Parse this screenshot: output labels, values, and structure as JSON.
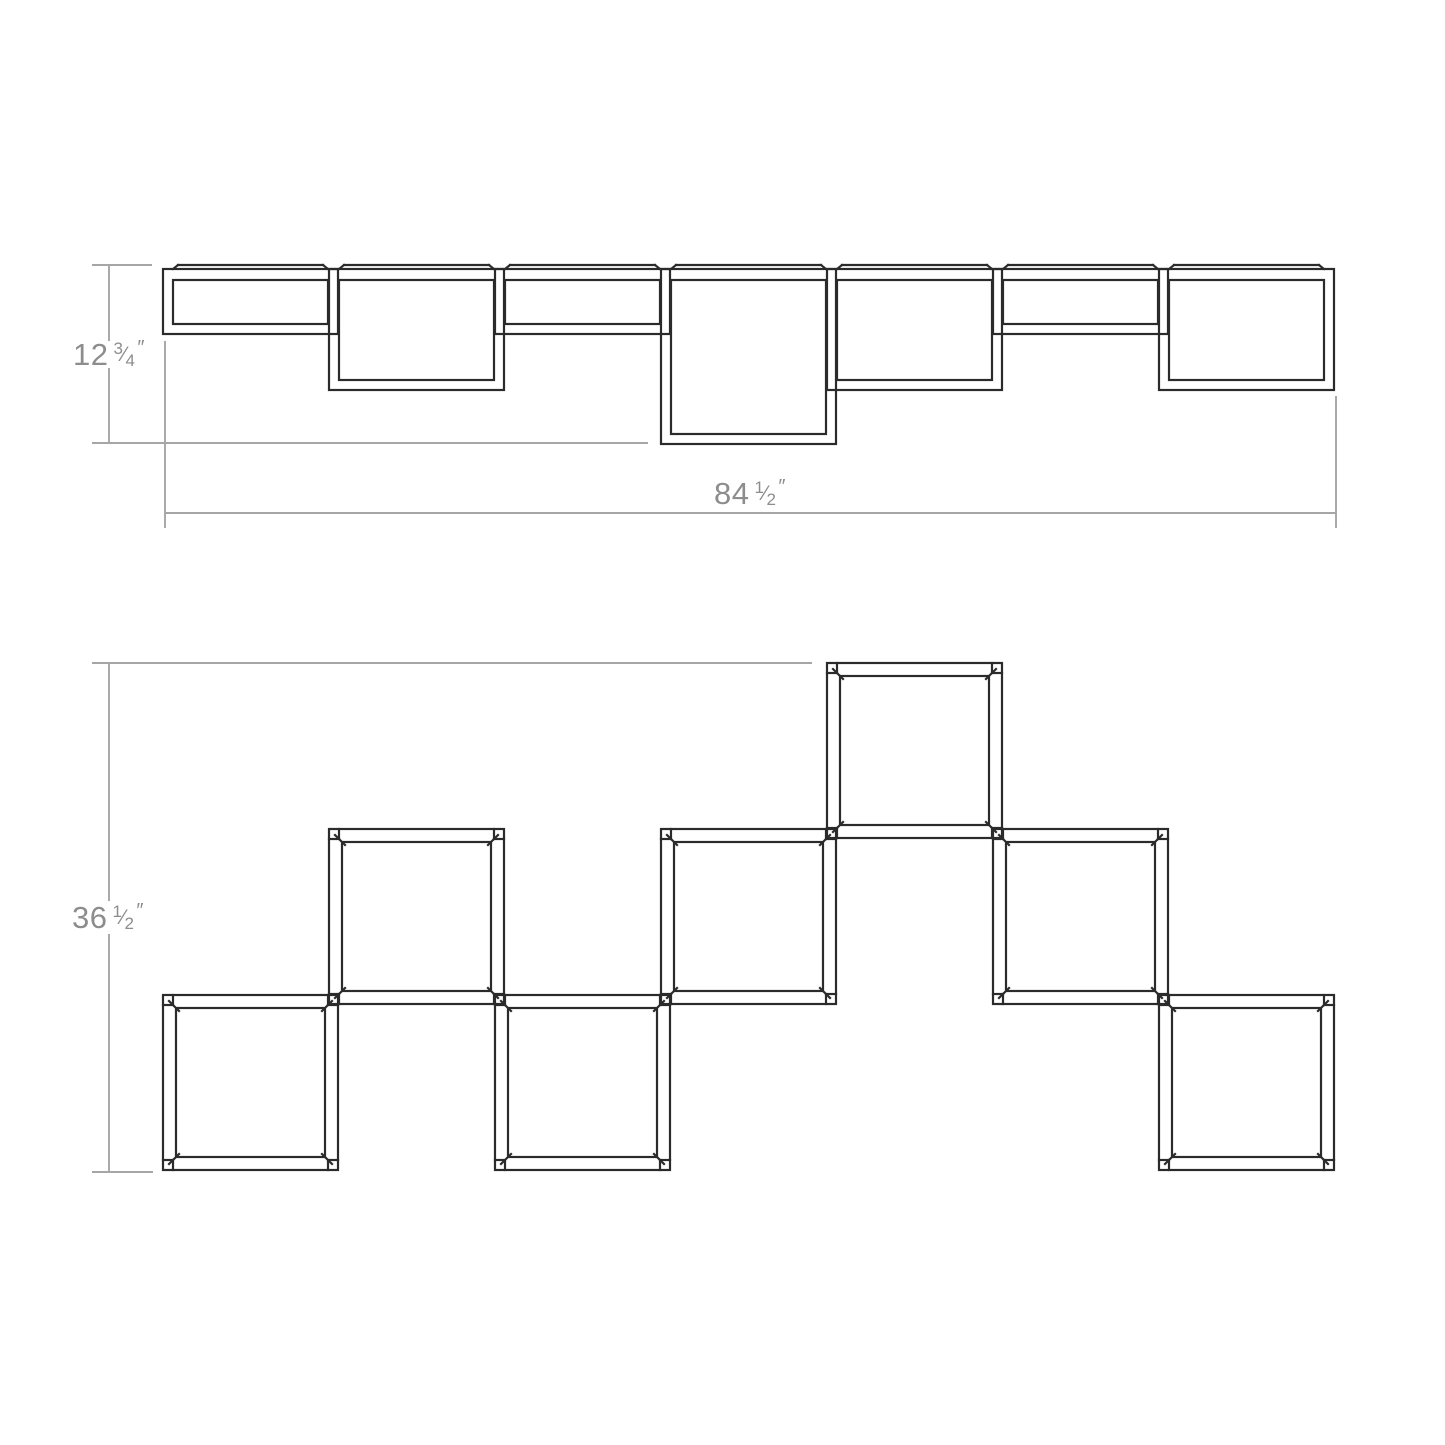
{
  "colors": {
    "background": "#ffffff",
    "line": "#2b2b2b",
    "dimension_line": "#a6a6a6",
    "label_text": "#8d8d8d"
  },
  "top_view": {
    "module_count": 7,
    "depth_pattern": [
      "shallow",
      "medium",
      "shallow",
      "deep",
      "medium",
      "shallow",
      "medium"
    ],
    "depth_label": {
      "whole": "12",
      "numerator": "3",
      "slash": "⁄",
      "denominator": "4",
      "unit": "″"
    },
    "width_label": {
      "whole": "84",
      "numerator": "1",
      "slash": "⁄",
      "denominator": "2",
      "unit": "″"
    }
  },
  "front_view": {
    "module_count": 7,
    "row_pattern": [
      "bottom",
      "middle",
      "bottom",
      "middle",
      "top",
      "middle",
      "bottom"
    ],
    "height_label": {
      "whole": "36",
      "numerator": "1",
      "slash": "⁄",
      "denominator": "2",
      "unit": "″"
    }
  }
}
